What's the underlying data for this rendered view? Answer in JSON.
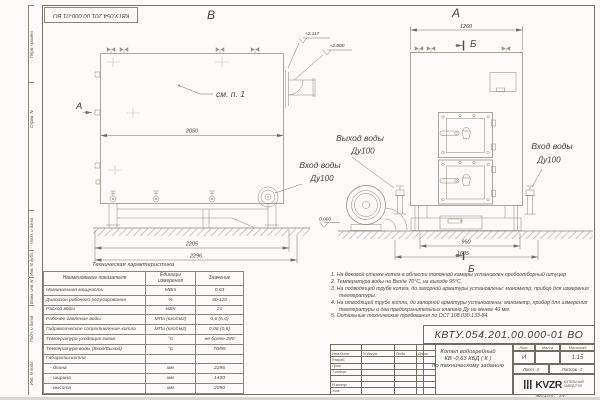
{
  "sheet": {
    "stamp_top": "КВТУ.054.201.00.000-01 ВО",
    "format_label": "Формат",
    "format_value": "А3"
  },
  "margin": {
    "cells": [
      "Перв. примен.",
      "Справ. N",
      "",
      "Подп. и дата",
      "Инв. N дубл.",
      "Взам. инв. N",
      "Подп. и дата",
      "Инв. N подл."
    ]
  },
  "drawing": {
    "view_b": "В",
    "view_a": "А",
    "view_dir": "А",
    "section_top": "Б",
    "section_bottom": "Б",
    "see_note": "см. п. 1",
    "elev_1": "+2.117",
    "elev_2": "+2.000",
    "elev_0": "0.000",
    "dim_2050": "2050",
    "dim_2205": "2205",
    "dim_2296": "2296",
    "dim_1260": "1260",
    "dim_960": "960",
    "dim_1605": "1605",
    "outlet_line1": "Выход воды",
    "outlet_line2": "Ду100",
    "inlet_line1": "Вход воды",
    "inlet_line2": "Ду100",
    "inlet_r_line1": "Вход воды",
    "inlet_r_line2": "Ду100"
  },
  "tech_table": {
    "title": "Техническая характеристика",
    "headers": [
      "Наименование показателя",
      "Единицы измерения",
      "Значение"
    ],
    "rows": [
      [
        "Номинальная мощность",
        "МВт",
        "0,63"
      ],
      [
        "Диапазон рабочего регулирования",
        "%",
        "40-110"
      ],
      [
        "Расход воды",
        "м3/ч",
        "21"
      ],
      [
        "Рабочее давление воды",
        "МПа (кгс/см2)",
        "0,6 (6,0)"
      ],
      [
        "Гидравлическое сопротивление котла",
        "МПа (кгс/см2)",
        "0,06 (0,6)"
      ],
      [
        "Температура уходящих газов",
        "°С",
        "не более 280"
      ],
      [
        "Температура воды (Вход/Выход)",
        "°С",
        "70/95"
      ],
      [
        "Габариты котла",
        "",
        ""
      ],
      [
        "   - длина",
        "мм",
        "2296"
      ],
      [
        "   - ширина",
        "мм",
        "1430"
      ],
      [
        "   - высота",
        "мм",
        "2050"
      ]
    ]
  },
  "notes": [
    "1.  На боковой стенке котла в области топочной камеры установлен пробоотборный штуцер",
    "2.  Температура воды на Входе 70°С, на выходе 95°С.",
    "3.  На подводящей трубе котла, до запорной арматуры установлены: манометр, прибор для измерения температуры.",
    "4.  На отводящей трубе котла, до запорной арматуры установлены: манометр, прибор для измерения температуры и два предохранительных клапана Ду не менее 40 мм.",
    "5.  Остальные технические требования по ОСТ 108.030.133-84."
  ],
  "title_block": {
    "doc_number": "КВТУ.054.201.00.000-01 ВО",
    "rev_cols": [
      "Изм.Лист",
      "N докум.",
      "Подп.",
      "Дата"
    ],
    "rev_rows": [
      "Разраб.",
      "Пров.",
      "Т.контр.",
      "",
      "Н.контр.",
      "Утв."
    ],
    "name_line1": "Котел водогрейный",
    "name_line2": "КВ -0,63  КБД  ( К )",
    "name_line3": "по техническому заданию",
    "lit_label": "Лит.",
    "mass_label": "Масса",
    "scale_label": "Масштаб",
    "lit_value": "И",
    "mass_value": "",
    "scale_value": "1:15",
    "sheet_label": "Лист",
    "sheet_num": "1",
    "sheets_label": "Листов",
    "sheets_num": "2",
    "logo": "KVZR",
    "logo_sub1": "КОТЕЛЬНЫЙ",
    "logo_sub2": "ЗАВОД РЭП"
  }
}
